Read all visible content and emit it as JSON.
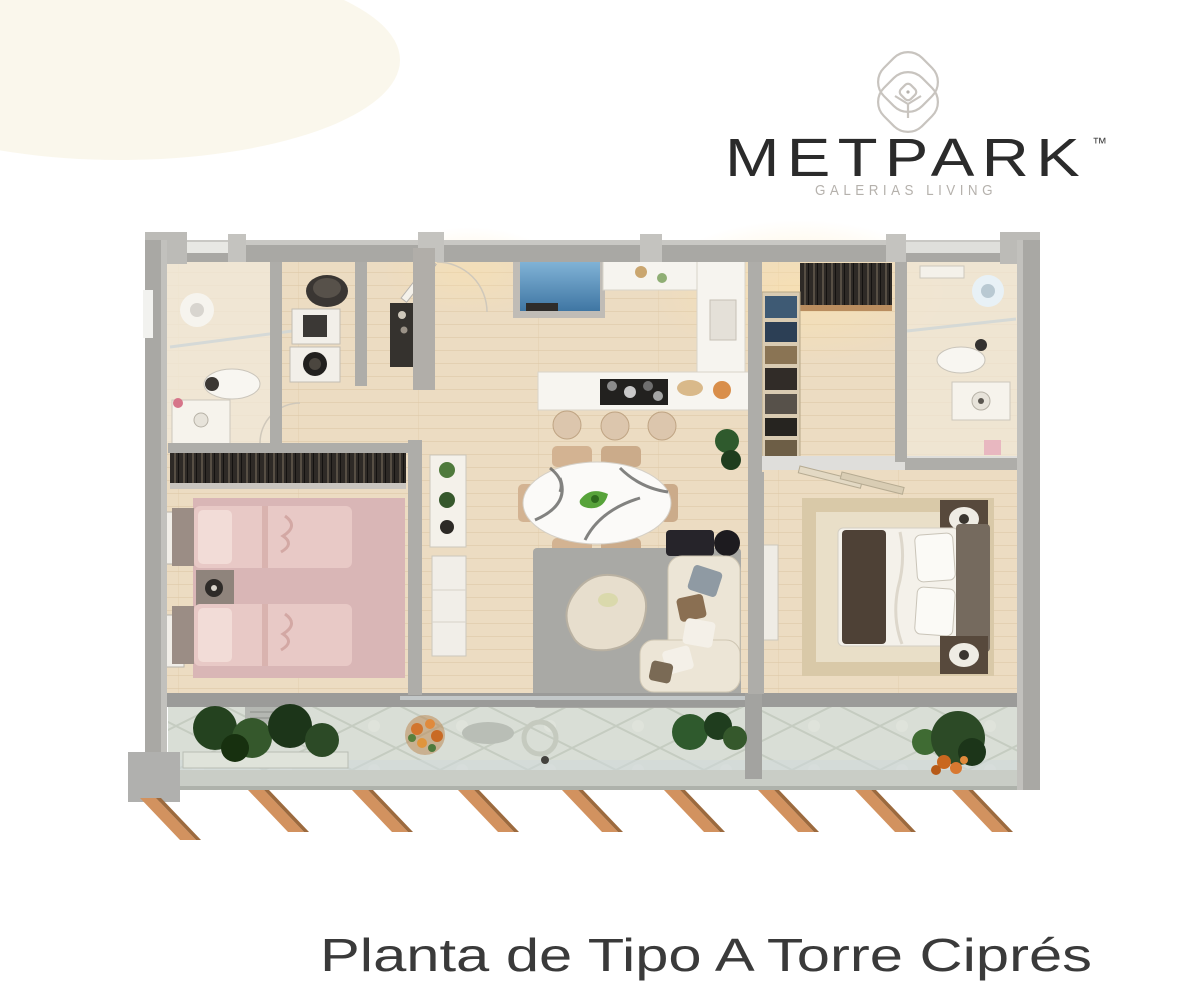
{
  "brand": {
    "logo_text": "METPARK",
    "logo_trademark": "™",
    "logo_tagline": "GALERIAS LIVING"
  },
  "caption": {
    "title": "Planta de Tipo A Torre Ciprés"
  },
  "icons": {
    "logo_mark": "overlapping-rounded-petals-icon"
  },
  "palette": {
    "background": "#ffffff",
    "wall_gray": "#a9a8a4",
    "wall_light": "#c9c8c4",
    "wood_floor": "#ecdcc2",
    "warm_glow": "#ffe2a8",
    "terrace_stone": "#d9ded6",
    "accent_blue": "#5e93bd",
    "rug_pink": "#d9b6b6",
    "bed_pink": "#e8c9c6",
    "rug_gray": "#a9a9a5",
    "sofa_cream": "#ece5d6",
    "master_rug_beige": "#d9c9a8",
    "closet_dark": "#2e2a26",
    "plant_green": "#2f5a2d",
    "flower_orange": "#d2752e",
    "wood_fin": "#d2925f",
    "logo_text": "#2b2b2b",
    "logo_tagline": "#b5b1ac",
    "caption_text": "#3a3a3a"
  }
}
